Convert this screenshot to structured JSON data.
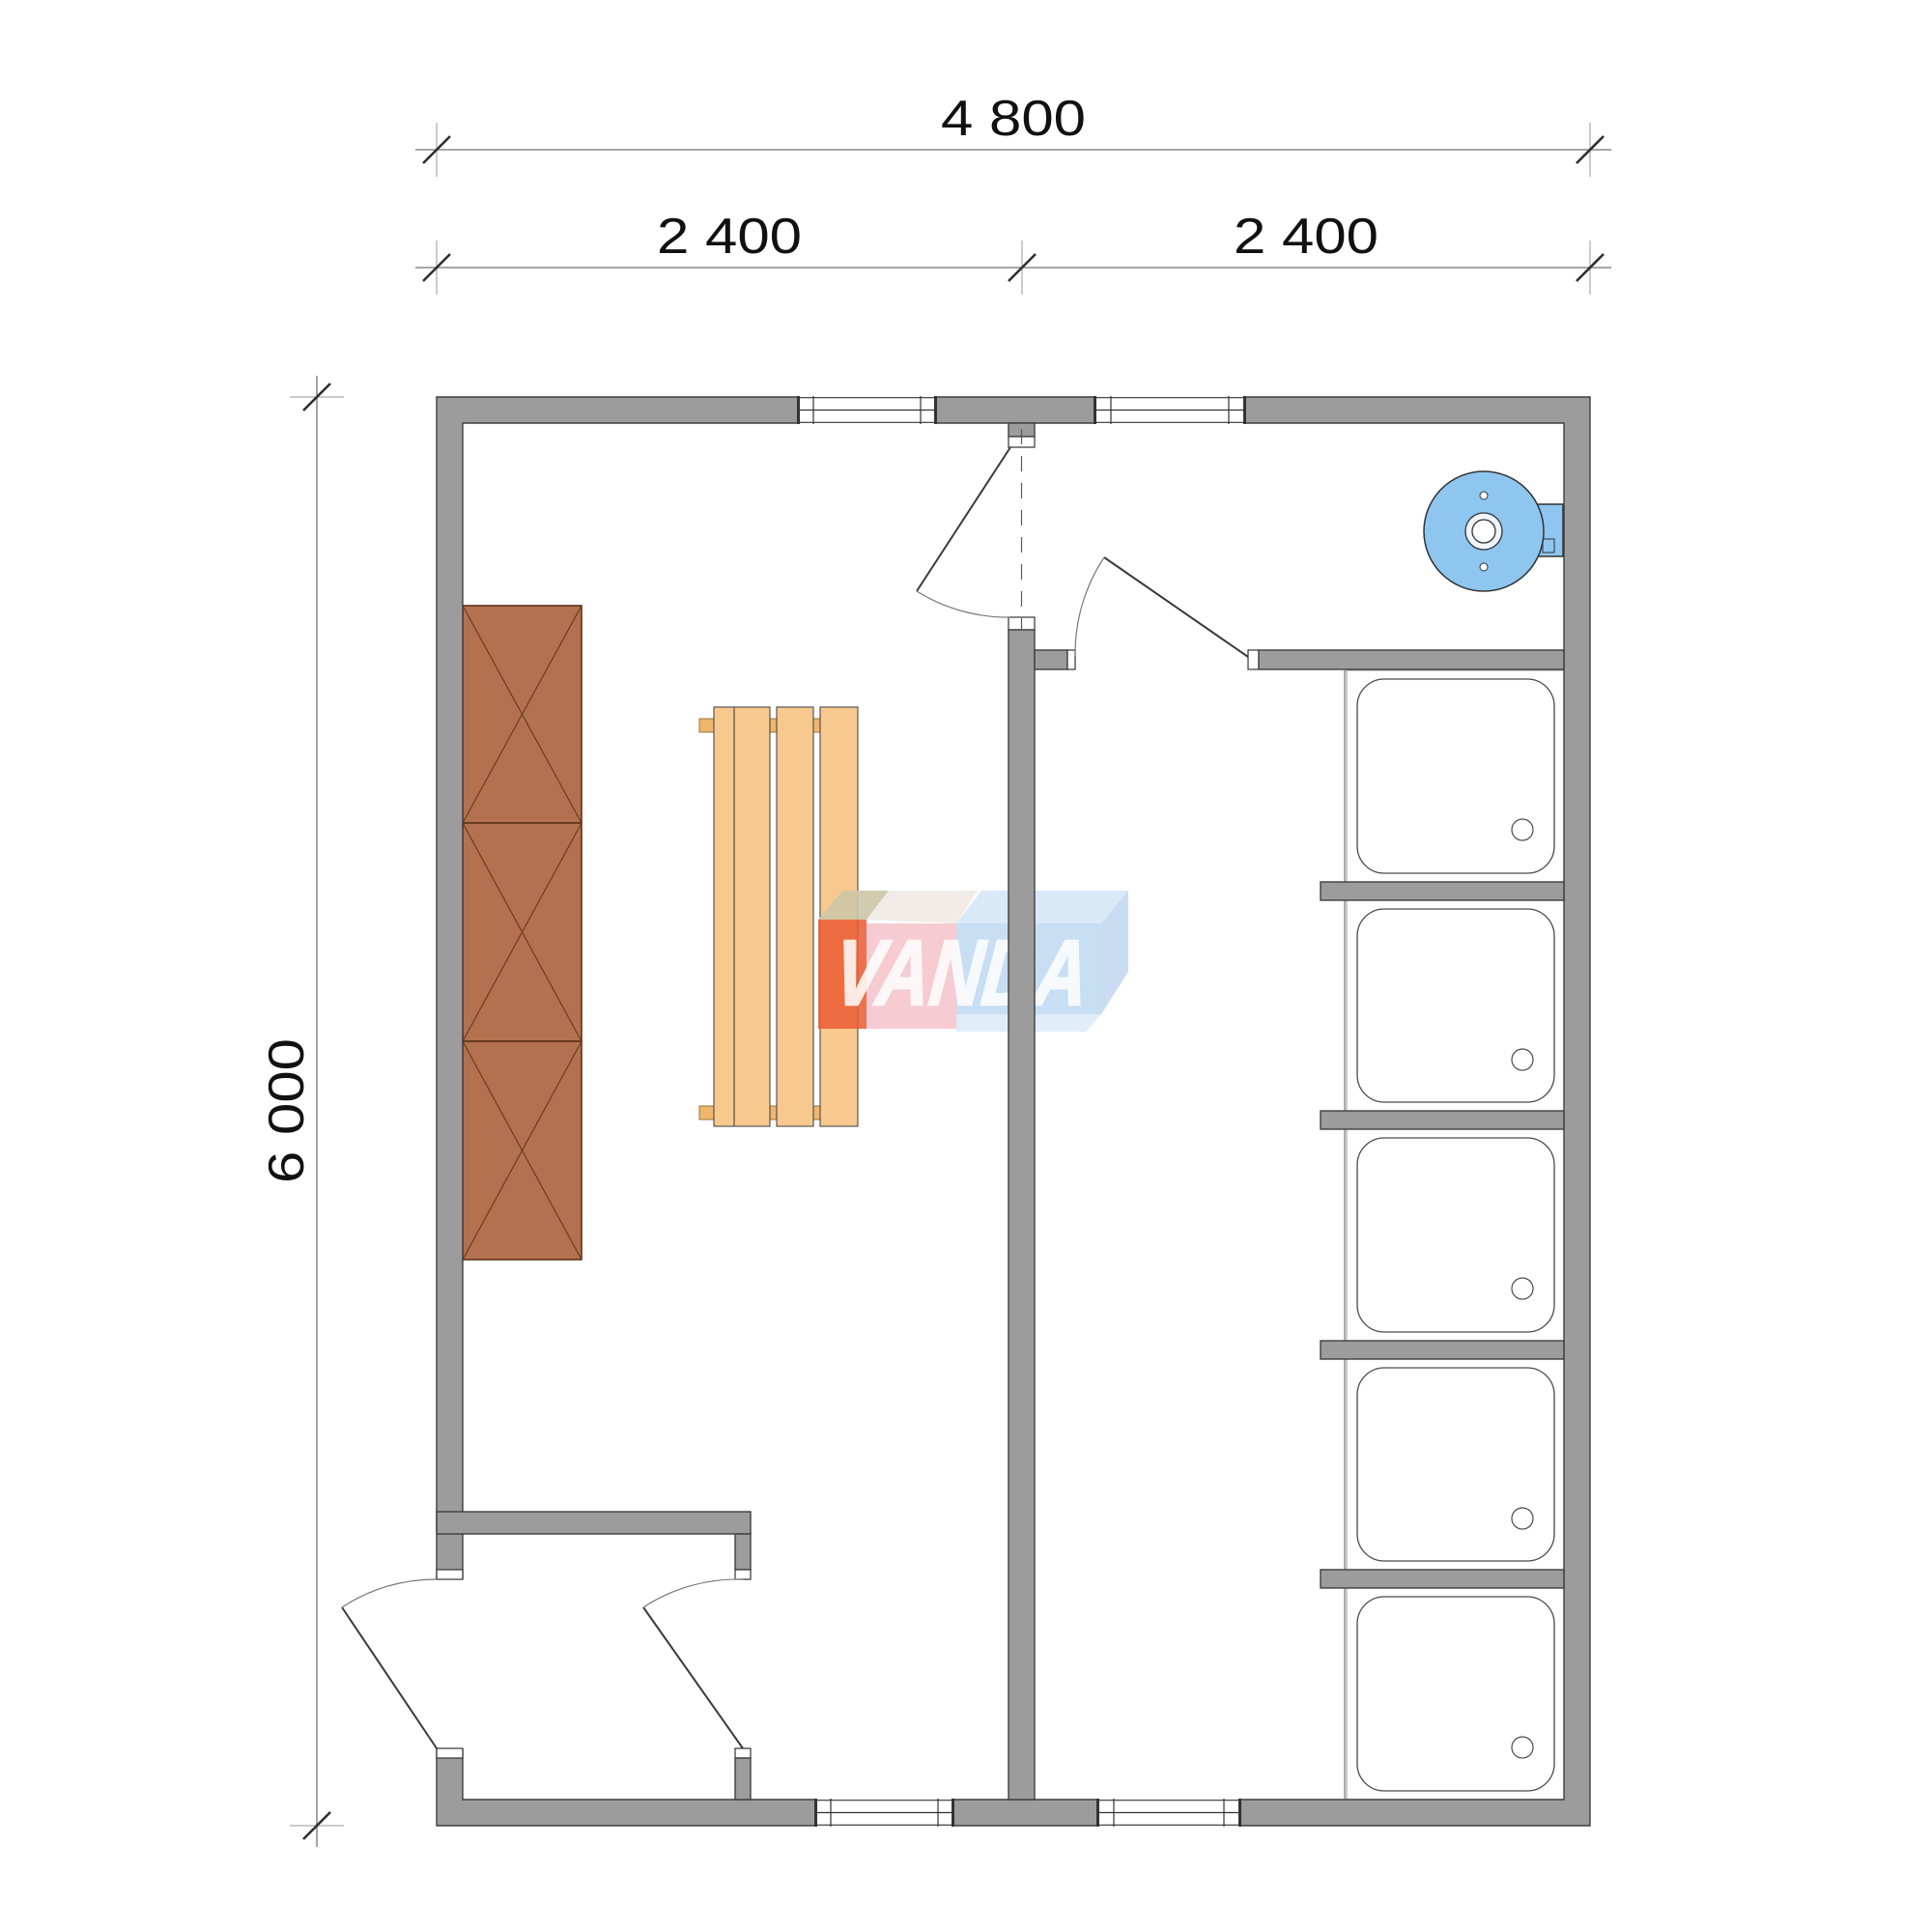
{
  "page": {
    "type": "architectural-floor-plan",
    "background": "#ffffff"
  },
  "dimensions": {
    "total_width": "4 800",
    "left_width": "2 400",
    "right_width": "2 400",
    "height": "6 000"
  },
  "logo": {
    "text": "VANDA"
  },
  "plan": {
    "rooms": [
      "sauna-room",
      "entry-vestibule",
      "heater-room",
      "shower-room"
    ],
    "shower_tray_count": 5,
    "cabinet_sections": 3,
    "bench_slats": 4
  },
  "colors": {
    "wall": "#9c9c9c",
    "wall-edge": "#3f3f3f",
    "frame-line": "#333333",
    "door-line": "#3a3a3a",
    "arc-line": "#777777",
    "cabinet": "#b4714f",
    "cabinet-edge": "#5d3318",
    "cabinet-line": "#6d3c20",
    "bench": "#f8c98f",
    "bench-support": "#f0b66e",
    "heater": "#8ec6f0",
    "fixture-edge": "#333333",
    "tray-edge": "#4a4a4a",
    "tray-cell": "#999999",
    "logo-orange": "#eb5f35",
    "logo-olive": "#ccc6a6",
    "logo-pink": "#f0a8b2",
    "logo-blue": "#bed8f1",
    "logo-blue-light": "#d4e5f7",
    "logo-blue-dark": "#c0d6ee",
    "logo-text": "#ffffff",
    "dim-line": "#9a9a9a",
    "dim-tick": "#2f2f2f",
    "dim-text": "#111111"
  }
}
